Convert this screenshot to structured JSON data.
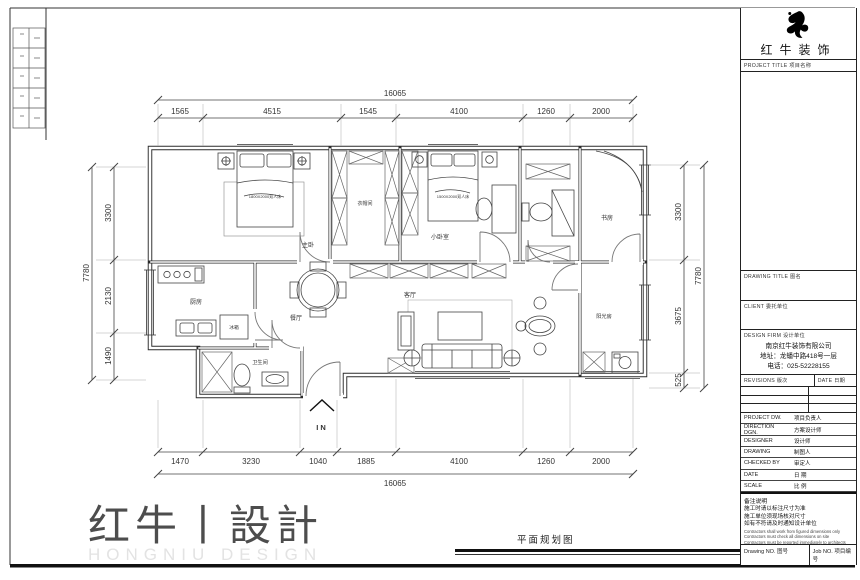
{
  "colors": {
    "line": "#2b2b2b",
    "dim": "#3d3d3d",
    "logo_black": "#000000",
    "faint_logo": "#e3e3e3"
  },
  "header_logo": {
    "brand": "红牛装饰",
    "project_title_label": "PROJECT TITLE  项目名称"
  },
  "title_block": {
    "drawing_title_label": "DRAWING TITLE  图名",
    "client_label": "CLIENT  委托单位",
    "design_firm_label": "DESIGN FIRM  设计单位",
    "firm_name": "南京红牛装饰有限公司",
    "firm_address": "地址：龙蟠中路418号一层",
    "firm_phone": "电话：025-52228155",
    "revisions_label": "REVISIONS  版次",
    "rev_date_label": "DATE  日期",
    "rows": [
      {
        "label": "PROJECT DW.",
        "value": "项目负责人"
      },
      {
        "label": "DIRECTION DGN.",
        "value": "方案设计师"
      },
      {
        "label": "DESIGNER",
        "value": "设计师"
      },
      {
        "label": "DRAWING",
        "value": "制图人"
      },
      {
        "label": "CHECKED BY",
        "value": "审定人"
      },
      {
        "label": "DATE",
        "value": "日 期"
      },
      {
        "label": "SCALE",
        "value": "比 例"
      }
    ],
    "notes": {
      "title": "备注说明",
      "cn1": "施工时请以标注尺寸为准",
      "cn2": "施工单位须现场核对尺寸",
      "cn3": "如有不符请及时通知设计单位",
      "en1": "Contractors shall work from figured dimensions only",
      "en2": "Contractors must check all dimensions on site",
      "en3": "Contractors must be reported immediately to architects"
    },
    "drawing_no_label": "Drawing NO.  图号",
    "job_no_label": "Job NO.  项目编号"
  },
  "plan": {
    "rooms": {
      "master": "主卧",
      "cloak": "衣帽间",
      "small": "小卧室",
      "study": "书房",
      "living": "客厅",
      "dining": "餐厅",
      "kitchen": "厨房",
      "bath": "卫生间",
      "balcony": "阳光房"
    },
    "furniture": {
      "bed_master": "1800X2000双人床",
      "bed_small": "1500X2000双人床",
      "fridge": "冰箱"
    },
    "entry": "IN",
    "dims": {
      "top_total": "16065",
      "top": [
        "1565",
        "4515",
        "1545",
        "4100",
        "1260",
        "2000"
      ],
      "bottom": [
        "1470",
        "3230",
        "1040",
        "1885",
        "4100",
        "1260",
        "2000"
      ],
      "bottom_total": "16065",
      "left_total": "7780",
      "left": [
        "3300",
        "2130",
        "1490"
      ],
      "right": [
        "3300",
        "3675",
        "525"
      ],
      "right_total": "7780"
    }
  },
  "footer": {
    "logo_cn": "红牛丨設計",
    "logo_en": "HONGNIU DESIGN",
    "drawing_title": "平面规划图"
  }
}
